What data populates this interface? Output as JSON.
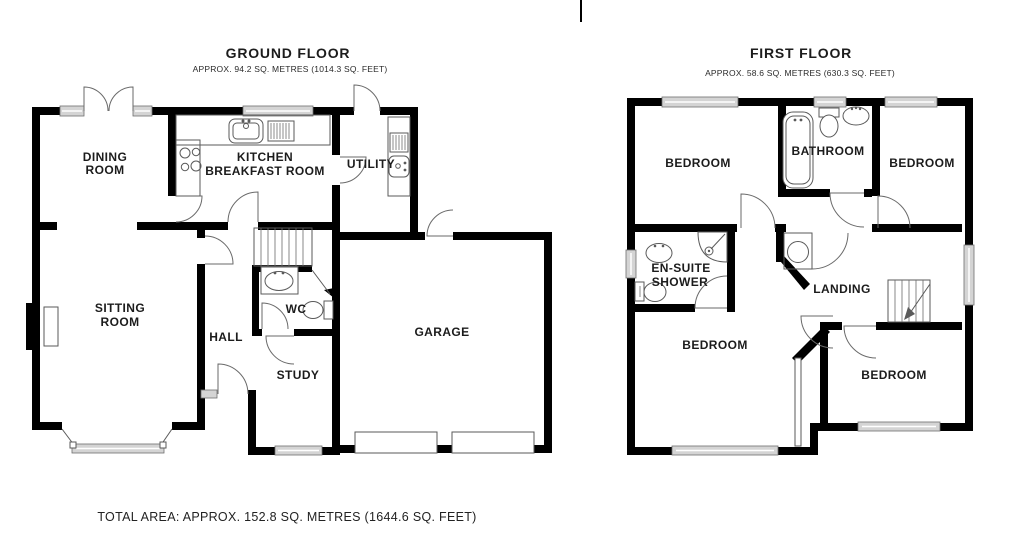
{
  "colors": {
    "background": "#ffffff",
    "wall": "#000000",
    "line": "#5a5a5a",
    "window_fill": "#d4d4d4",
    "text": "#1c1c1c"
  },
  "ground_floor": {
    "title": "GROUND FLOOR",
    "subtitle": "APPROX. 94.2 SQ. METRES (1014.3 SQ. FEET)",
    "rooms": [
      {
        "id": "dining-room",
        "lines": [
          "DINING",
          "ROOM"
        ]
      },
      {
        "id": "kitchen-breakfast-room",
        "lines": [
          "KITCHEN",
          "BREAKFAST ROOM"
        ]
      },
      {
        "id": "utility",
        "lines": [
          "UTILITY"
        ]
      },
      {
        "id": "sitting-room",
        "lines": [
          "SITTING",
          "ROOM"
        ]
      },
      {
        "id": "hall",
        "lines": [
          "HALL"
        ]
      },
      {
        "id": "wc",
        "lines": [
          "WC"
        ]
      },
      {
        "id": "study",
        "lines": [
          "STUDY"
        ]
      },
      {
        "id": "garage",
        "lines": [
          "GARAGE"
        ]
      }
    ],
    "fixtures": [
      "french-doors",
      "windows",
      "kitchen-sink",
      "draining-board",
      "hob",
      "utility-sink",
      "utility-appliance",
      "staircase",
      "wc-basin",
      "wc-toilet",
      "fireplace",
      "bay-window",
      "front-door",
      "garage-doors"
    ]
  },
  "first_floor": {
    "title": "FIRST FLOOR",
    "subtitle": "APPROX. 58.6 SQ. METRES (630.3 SQ. FEET)",
    "rooms": [
      {
        "id": "bedroom-top-left",
        "lines": [
          "BEDROOM"
        ]
      },
      {
        "id": "bathroom",
        "lines": [
          "BATHROOM"
        ]
      },
      {
        "id": "bedroom-top-right",
        "lines": [
          "BEDROOM"
        ]
      },
      {
        "id": "en-suite-shower",
        "lines": [
          "EN-SUITE",
          "SHOWER"
        ]
      },
      {
        "id": "landing",
        "lines": [
          "LANDING"
        ]
      },
      {
        "id": "bedroom-bottom-left",
        "lines": [
          "BEDROOM"
        ]
      },
      {
        "id": "bedroom-bottom-right",
        "lines": [
          "BEDROOM"
        ]
      }
    ],
    "fixtures": [
      "bath",
      "toilet",
      "basin",
      "shower-cubicle",
      "en-suite-basin",
      "en-suite-toilet",
      "hot-water-cylinder",
      "staircase",
      "windows"
    ]
  },
  "footer": {
    "total_area_label": "TOTAL AREA: APPROX. 152.8 SQ. METRES (1644.6 SQ. FEET)"
  }
}
